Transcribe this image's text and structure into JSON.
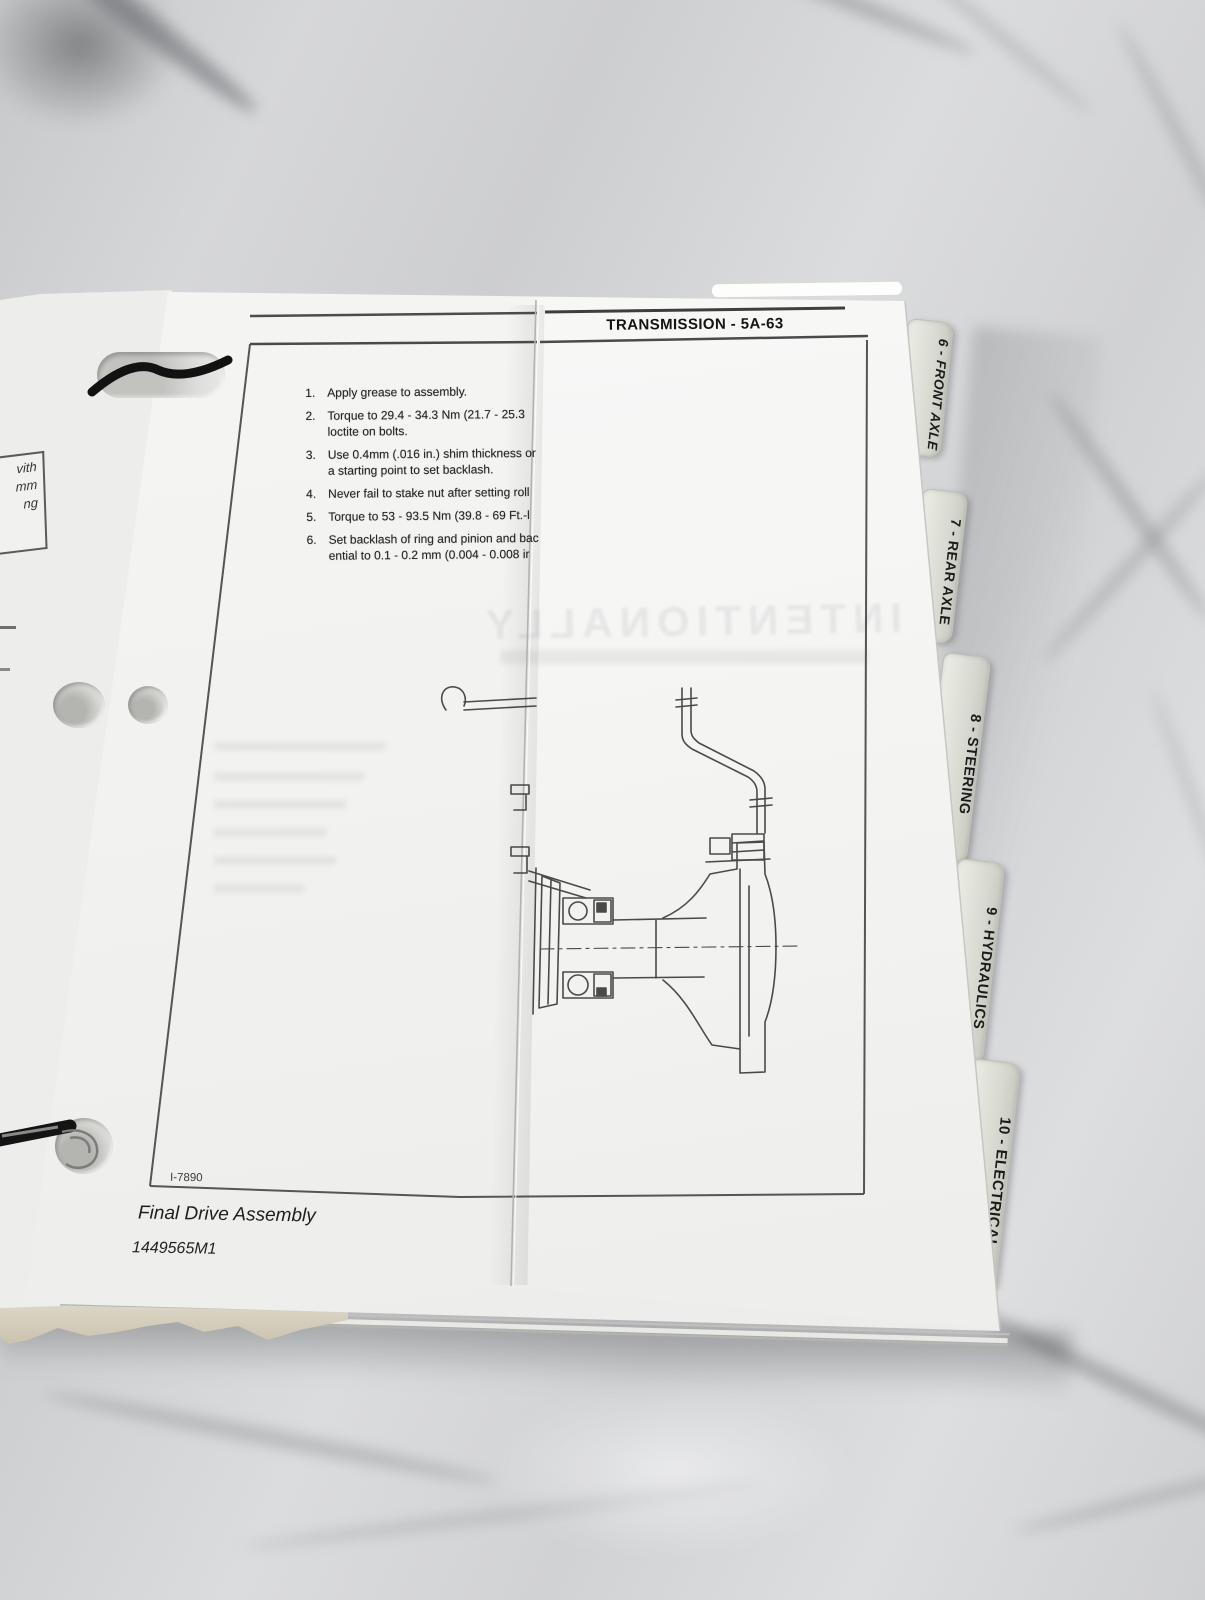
{
  "header": {
    "title": "TRANSMISSION - 5A-63"
  },
  "instructions": [
    {
      "num": "1.",
      "line1": "Apply grease to assembly.",
      "line2": ""
    },
    {
      "num": "2.",
      "line1": "Torque to 29.4 - 34.3 Nm (21.7 - 25.3",
      "line2": "loctite on bolts."
    },
    {
      "num": "3.",
      "line1": "Use 0.4mm (.016 in.) shim thickness or",
      "line2": "a starting point to set backlash."
    },
    {
      "num": "4.",
      "line1": "Never fail to stake nut after setting roll",
      "line2": ""
    },
    {
      "num": "5.",
      "line1": "Torque to 53 - 93.5 Nm (39.8 - 69 Ft.-l",
      "line2": ""
    },
    {
      "num": "6.",
      "line1": "Set backlash of ring and pinion and bacl",
      "line2": "ential to 0.1 - 0.2 mm (0.004 - 0.008 ir"
    }
  ],
  "figure": {
    "ref": "I-7890",
    "caption": "Final Drive Assembly",
    "part_number": "1449565M1",
    "bleed_text": "INTENTIONALLY"
  },
  "left_page_fragment": {
    "line1": "vith",
    "line2": "mm",
    "line3": "ng"
  },
  "tabs": [
    {
      "label": "6 - FRONT AXLE"
    },
    {
      "label": "7 - REAR AXLE"
    },
    {
      "label": "8 - STEERING"
    },
    {
      "label": "9 - HYDRAULICS"
    },
    {
      "label": "10 - ELECTRICAL"
    }
  ]
}
